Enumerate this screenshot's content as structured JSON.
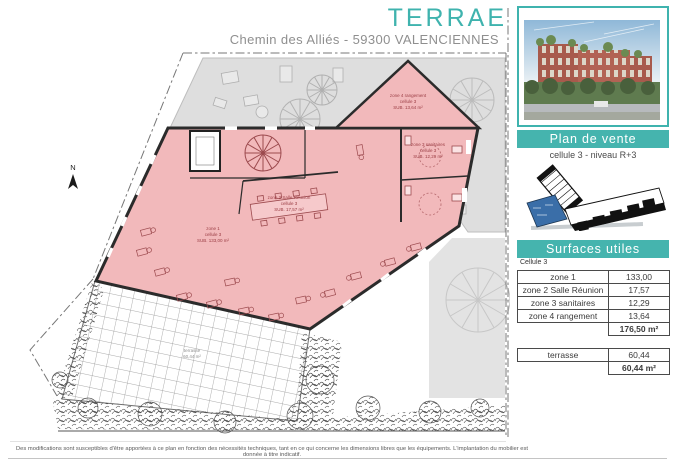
{
  "header": {
    "title": "TERRAE",
    "subtitle": "Chemin des Alliés - 59300 VALENCIENNES"
  },
  "colors": {
    "accent_teal": "#3fb3ae",
    "plan_pink": "#f2b9bb",
    "highlight_blue": "#3a6ea8"
  },
  "plan": {
    "north_label": "N",
    "labels": {
      "zone4": {
        "l1": "zone 4 rangement",
        "l2": "cellule 3",
        "l3": "SUB. 13,64 m²"
      },
      "zone3": {
        "l1": "zone 3 sanitaires",
        "l2": "cellule 3",
        "l3": "SUB. 12,29 m²"
      },
      "zone2": {
        "l1": "zone 2 Salle Réunion",
        "l2": "cellule 3",
        "l3": "SUB. 17,57 m²"
      },
      "zone1": {
        "l1": "zone 1",
        "l2": "cellule 3",
        "l3": "SUB. 133,00 m²"
      },
      "terrasse": {
        "l1": "terrasse",
        "l2": "60,44 m²"
      }
    }
  },
  "sidebar": {
    "plan_banner": "Plan de vente",
    "cell_info": "cellule 3 - niveau R+3",
    "surfaces_banner": "Surfaces utiles",
    "table_caption": "Cellule 3",
    "surfaces": {
      "rows": [
        {
          "label": "zone 1",
          "value": "133,00"
        },
        {
          "label": "zone 2 Salle Réunion",
          "value": "17,57"
        },
        {
          "label": "zone 3 sanitaires",
          "value": "12,29"
        },
        {
          "label": "zone 4 rangement",
          "value": "13,64"
        }
      ],
      "total": "176,50 m²"
    },
    "terrace": {
      "label": "terrasse",
      "value": "60,44",
      "total": "60,44 m²"
    }
  },
  "footer": {
    "disclaimer": "Des modifications sont susceptibles d'être apportées à ce plan en fonction des nécessités techniques, tant en ce qui concerne les dimensions libres que les équipements. L'implantation du mobilier est donnée à titre indicatif."
  }
}
